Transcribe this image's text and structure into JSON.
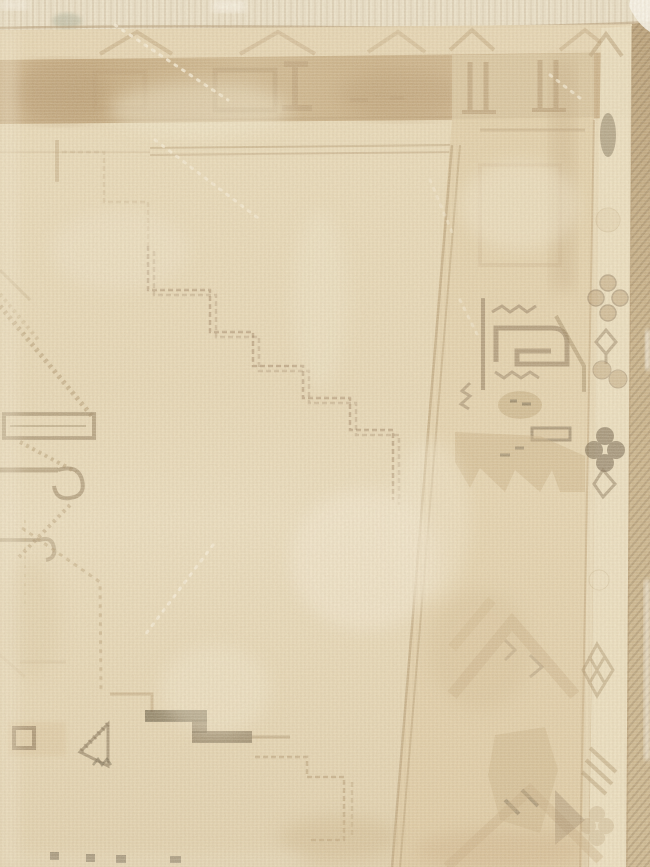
{
  "image": {
    "kind": "photograph",
    "subject": "faded-antique-rug-corner"
  },
  "colors": {
    "field": "#e8d9b7",
    "field_light": "#f2e8cf",
    "field_shadow": "#d8c49d",
    "band_tan": "#c9ae84",
    "band_dark": "#b2946a",
    "guard_cream": "#ebdebf",
    "corner_block": "#d8c59f",
    "motif_tan": "#ab9168",
    "motif_brown": "#8a7355",
    "motif_dark": "#6e6047",
    "motif_olive": "#6f634a",
    "step_line": "#9c8260",
    "selvage": "#c3aa81",
    "fringe": "#eae0c8",
    "white_edge": "#faf6ec",
    "stain": "#a8ad97"
  },
  "scene": {
    "parts": [
      "top-fringe-edge",
      "top-outer-guard-with-chevrons",
      "top-main-border-band",
      "right-main-border-band",
      "right-outer-guard-with-rosettes",
      "right-selvage-edge",
      "cream-field",
      "stepped-diagonal-lines",
      "hooked-medallion-fragment-left",
      "hooked-square-border-motif",
      "serrated-animal-border-motif",
      "small-square-and-triangle-motifs",
      "dark-stepped-bar-motif",
      "worn-white-fold-lines"
    ]
  }
}
